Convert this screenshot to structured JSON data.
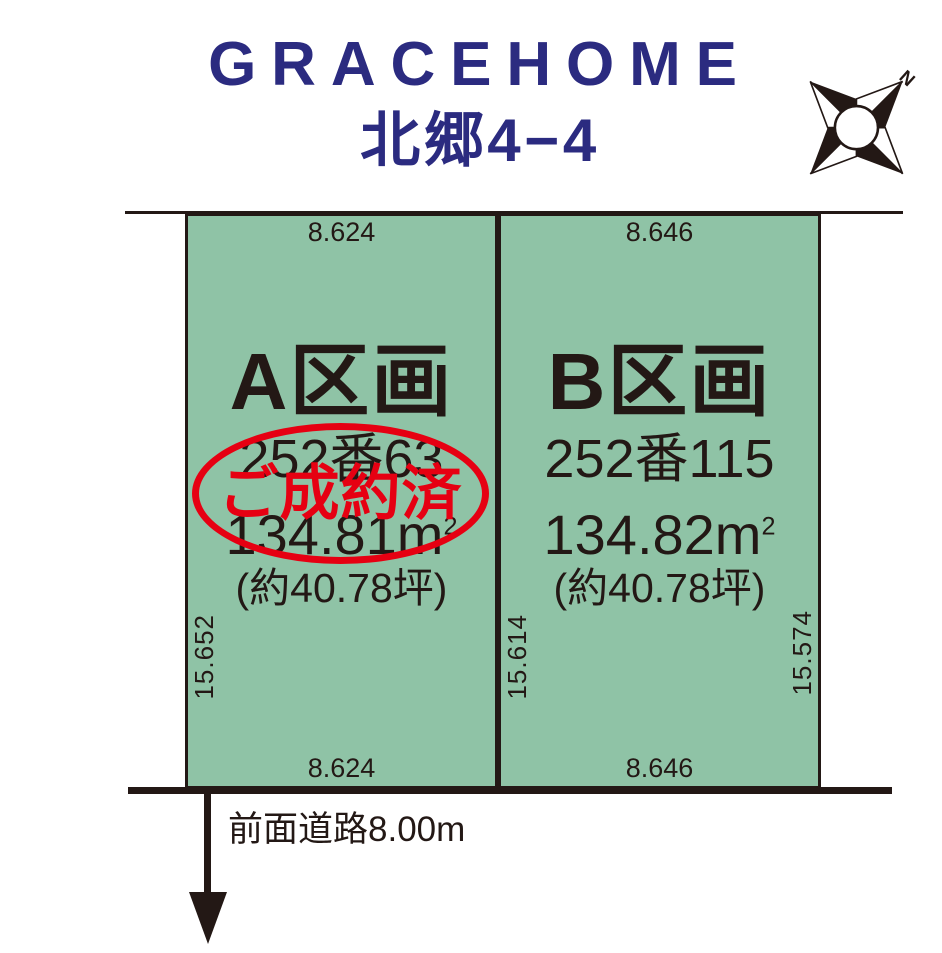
{
  "header": {
    "brand": "GRACEHOME",
    "location": "北郷4−4"
  },
  "compass": {
    "north_label": "N"
  },
  "plots": [
    {
      "name": "A区画",
      "lot_number": "252番63",
      "area_value": "134.81m",
      "area_sup": "2",
      "area_tsubo": "(約40.78坪)",
      "width_top": "8.624",
      "width_bottom": "8.624",
      "depth_left": "15.652",
      "status_stamp": "ご成約済"
    },
    {
      "name": "B区画",
      "lot_number": "252番115",
      "area_value": "134.82m",
      "area_sup": "2",
      "area_tsubo": "(約40.78坪)",
      "width_top": "8.646",
      "width_bottom": "8.646",
      "depth_left": "15.614",
      "depth_right": "15.574"
    }
  ],
  "road": {
    "label": "前面道路8.00m"
  },
  "colors": {
    "brand_navy": "#2b2b80",
    "plot_green": "#8fc3a6",
    "ink_black": "#231815",
    "stamp_red": "#e60012"
  }
}
